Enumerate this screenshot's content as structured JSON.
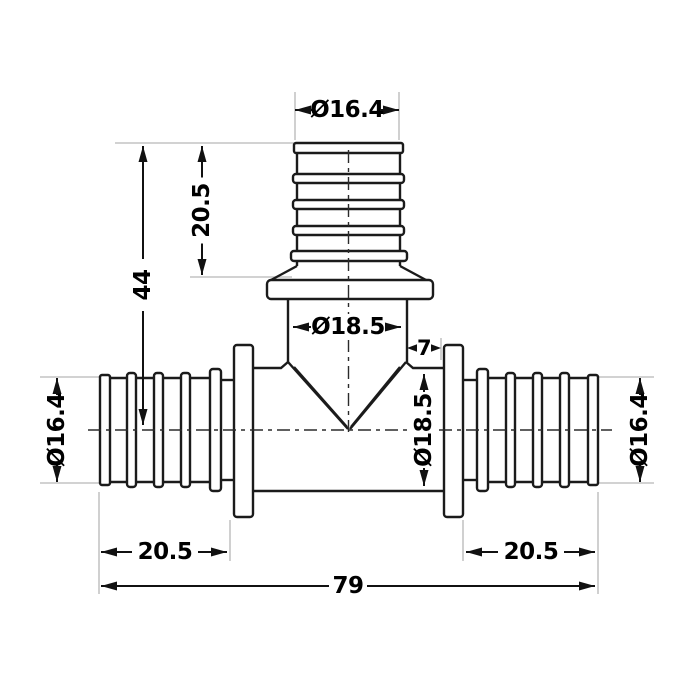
{
  "drawing": {
    "kind": "technical dimension drawing",
    "part": "tee pipe fitting with barbed ends",
    "colors": {
      "background": "#ffffff",
      "outline": "#1b1b1b",
      "dimension": "#111111",
      "extension_line": "#c4c4c4"
    },
    "dimensions": {
      "top_od": "Ø16.4",
      "branch_barb": "20.5",
      "branch_height": "44",
      "branch_id": "Ø18.5",
      "offset": "7",
      "body_id": "Ø18.5",
      "left_od": "Ø16.4",
      "right_od": "Ø16.4",
      "left_barb": "20.5",
      "right_barb": "20.5",
      "overall": "79"
    },
    "values": {
      "top_od_mm": 16.4,
      "branch_barb_mm": 20.5,
      "branch_height_mm": 44,
      "branch_id_mm": 18.5,
      "offset_mm": 7,
      "body_id_mm": 18.5,
      "side_od_mm": 16.4,
      "side_barb_mm": 20.5,
      "overall_mm": 79
    }
  }
}
